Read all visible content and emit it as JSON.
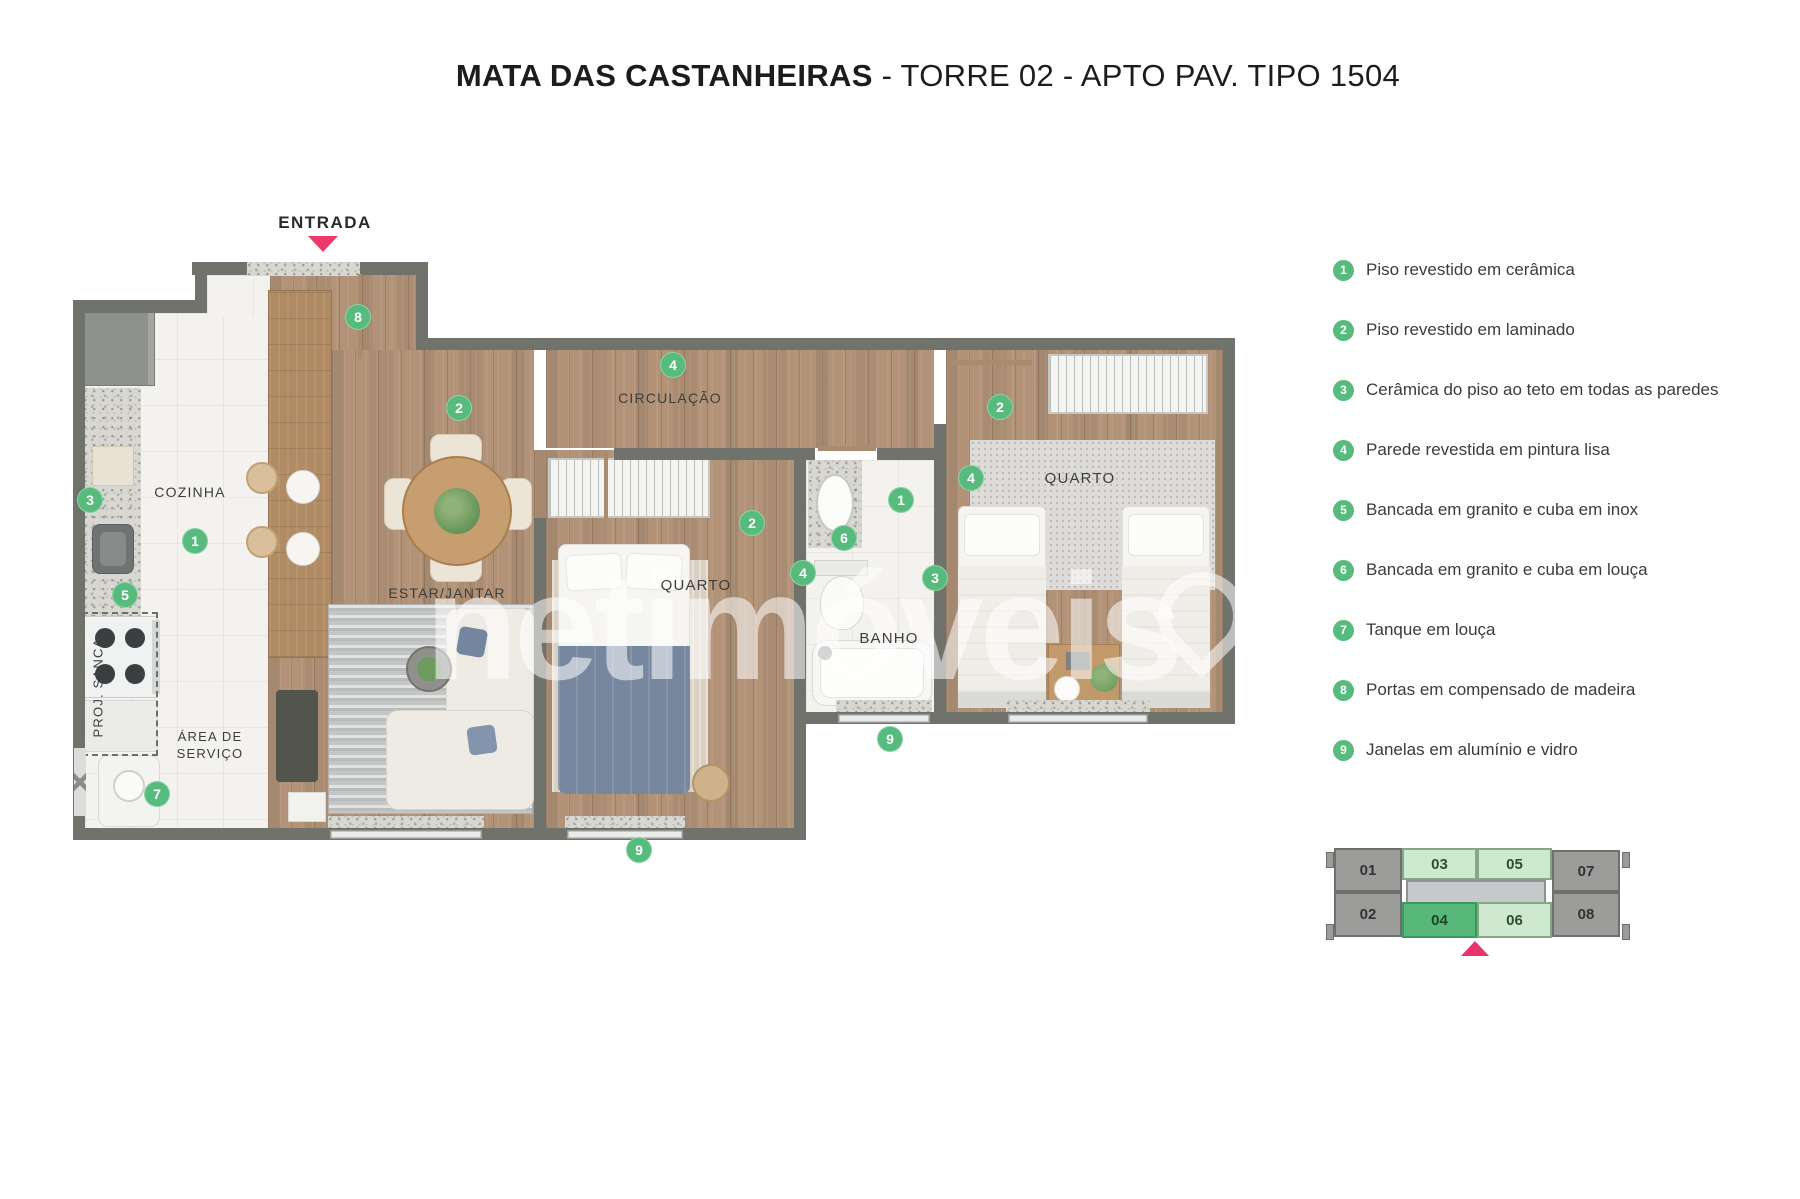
{
  "title": {
    "bold": "MATA DAS CASTANHEIRAS",
    "rest": " - TORRE 02 - APTO PAV. TIPO 1504"
  },
  "entrance": {
    "label": "ENTRADA"
  },
  "watermark": {
    "text": "netimóveis"
  },
  "rooms": {
    "kitchen": "COZINHA",
    "living": "ESTAR/JANTAR",
    "hall": "CIRCULAÇÃO",
    "bedroom1": "QUARTO",
    "bedroom2": "QUARTO",
    "bath": "BANHO",
    "service": "ÁREA DE\nSERVIÇO",
    "sanca": "PROJ. SANCA"
  },
  "markers": [
    {
      "n": "8",
      "x": 358,
      "y": 317
    },
    {
      "n": "2",
      "x": 459,
      "y": 408
    },
    {
      "n": "4",
      "x": 673,
      "y": 365
    },
    {
      "n": "2",
      "x": 1000,
      "y": 407
    },
    {
      "n": "3",
      "x": 90,
      "y": 500
    },
    {
      "n": "1",
      "x": 195,
      "y": 541
    },
    {
      "n": "5",
      "x": 125,
      "y": 595
    },
    {
      "n": "2",
      "x": 752,
      "y": 523
    },
    {
      "n": "4",
      "x": 971,
      "y": 478
    },
    {
      "n": "1",
      "x": 901,
      "y": 500
    },
    {
      "n": "6",
      "x": 844,
      "y": 538
    },
    {
      "n": "4",
      "x": 803,
      "y": 573
    },
    {
      "n": "3",
      "x": 935,
      "y": 578
    },
    {
      "n": "7",
      "x": 157,
      "y": 794
    },
    {
      "n": "9",
      "x": 890,
      "y": 739
    },
    {
      "n": "9",
      "x": 639,
      "y": 850
    }
  ],
  "legend": [
    {
      "n": "1",
      "text": "Piso revestido em cerâmica"
    },
    {
      "n": "2",
      "text": "Piso revestido em laminado"
    },
    {
      "n": "3",
      "text": "Cerâmica do piso ao teto em todas as paredes"
    },
    {
      "n": "4",
      "text": "Parede revestida em pintura lisa"
    },
    {
      "n": "5",
      "text": "Bancada em granito e cuba em inox"
    },
    {
      "n": "6",
      "text": "Bancada em granito e cuba em louça"
    },
    {
      "n": "7",
      "text": "Tanque em louça"
    },
    {
      "n": "8",
      "text": "Portas em compensado de madeira"
    },
    {
      "n": "9",
      "text": "Janelas em alumínio e vidro"
    }
  ],
  "key_plan": {
    "units": [
      {
        "id": "01",
        "variant": "gray"
      },
      {
        "id": "02",
        "variant": "gray"
      },
      {
        "id": "03",
        "variant": "light"
      },
      {
        "id": "04",
        "variant": "active"
      },
      {
        "id": "05",
        "variant": "light"
      },
      {
        "id": "06",
        "variant": "light"
      },
      {
        "id": "07",
        "variant": "gray"
      },
      {
        "id": "08",
        "variant": "gray"
      }
    ],
    "highlighted_unit": "04"
  },
  "colors": {
    "marker_green": "#56bb7c",
    "active_unit_green": "#57b87a",
    "light_unit_green": "#cfe8d0",
    "entrance_pink": "#ee3a6a",
    "wall_gray": "#70726c"
  }
}
